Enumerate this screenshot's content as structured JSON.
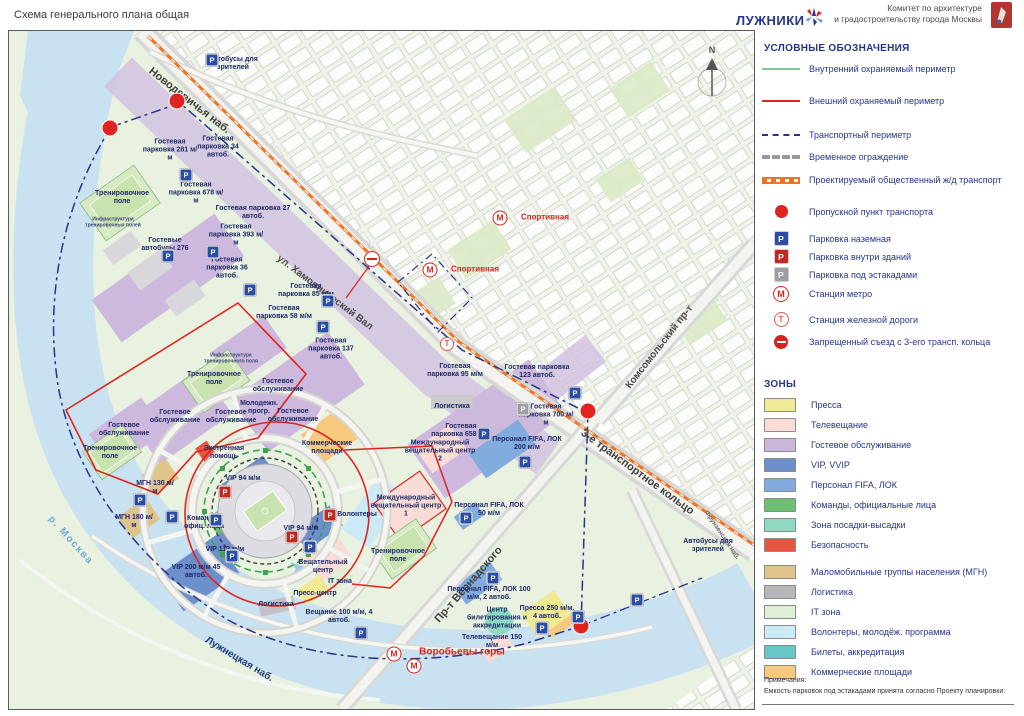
{
  "header": {
    "title": "Схема генерального плана общая",
    "logo_text": "ЛУЖНИКИ",
    "committee_line1": "Комитет по архитектуре",
    "committee_line2": "и градостроительству города Москвы"
  },
  "colors": {
    "perimeter_inner": "#7DC98F",
    "perimeter_outer": "#E0231E",
    "transport_perimeter": "#27348B",
    "temporary_fence": "#9A9A9A",
    "rail_transport": "#EE7425",
    "checkpoint": "#E0231E",
    "metro": "#D7241E",
    "rail_station": "#E2564F",
    "parking_ground": "#2B4EA2",
    "parking_inside": "#C22A21",
    "parking_under": "#9D9DA4"
  },
  "legend": {
    "title": "УСЛОВНЫЕ ОБОЗНАЧЕНИЯ",
    "items": [
      {
        "label": "Внутренний охраняемый периметр"
      },
      {
        "label": "Внешний охраняемый периметр"
      },
      {
        "label": "Транспортный периметр"
      },
      {
        "label": "Временное ограждение"
      },
      {
        "label": "Проектируемый общественный ж/д транспорт"
      },
      {
        "label": "Пропускной пункт транспорта"
      },
      {
        "label": "Парковка наземная"
      },
      {
        "label": "Парковка внутри зданий"
      },
      {
        "label": "Парковка под эстакадами"
      },
      {
        "label": "Станция метро"
      },
      {
        "label": "Станция железной дороги"
      },
      {
        "label": "Запрещенный съезд с 3-его трансп. кольца"
      }
    ],
    "zones_title": "ЗОНЫ",
    "zones": [
      {
        "label": "Пресса",
        "color": "#F0EA96"
      },
      {
        "label": "Телевещание",
        "color": "#F9DCD5"
      },
      {
        "label": "Гостевое обслуживание",
        "color": "#CBB6DC"
      },
      {
        "label": "VIP, VVIP",
        "color": "#6D8FCB"
      },
      {
        "label": "Персонал FIFA, ЛОК",
        "color": "#82ACDE"
      },
      {
        "label": "Команды, официальные лица",
        "color": "#6CBE70"
      },
      {
        "label": "Зона посадки-высадки",
        "color": "#8ED9C2"
      },
      {
        "label": "Безопасность",
        "color": "#E85440"
      },
      {
        "label": "Маломобильные группы населения (МГН)",
        "color": "#DFC489"
      },
      {
        "label": "Логистика",
        "color": "#B5B5BA"
      },
      {
        "label": "IT зона",
        "color": "#DFEFD6"
      },
      {
        "label": "Волонтеры, молодёж. программа",
        "color": "#CCE9F6"
      },
      {
        "label": "Билеты, аккредитация",
        "color": "#66C6C8"
      },
      {
        "label": "Коммерческие площади",
        "color": "#F6CA7E"
      }
    ],
    "notes_title": "Примечания:",
    "notes_text": "Емкость парковок под эстакадами принята согласно Проекту планировки."
  },
  "map": {
    "compass": "N",
    "p_glyph": "P",
    "m_glyph": "М",
    "t_glyph": "Т",
    "streets": [
      {
        "text": "Новодевичья наб.",
        "x": 150,
        "y": 64,
        "rot": 38,
        "cls": "street-lg"
      },
      {
        "text": "ул. Хамовнический Вал",
        "x": 278,
        "y": 252,
        "rot": 37
      },
      {
        "text": "Комсомольский пр-т",
        "x": 628,
        "y": 382,
        "rot": -52
      },
      {
        "text": "3-е транспортное кольцо",
        "x": 582,
        "y": 426,
        "rot": 36,
        "cls": "street-lg"
      },
      {
        "text": "Пр-т Вернадского",
        "x": 437,
        "y": 615,
        "rot": -49,
        "cls": "street-lg"
      },
      {
        "text": "Лужнецкая наб.",
        "x": 206,
        "y": 634,
        "rot": 31,
        "cls": "street-navy"
      },
      {
        "text": "р. Москва",
        "x": 50,
        "y": 512,
        "rot": 48,
        "cls": "street-water"
      },
      {
        "text": "Фрунзенская наб.",
        "x": 706,
        "y": 508,
        "rot": 56,
        "cls": "street-sm"
      }
    ],
    "labels": [
      {
        "text": "Автобусы для зрителей",
        "x": 233,
        "y": 64,
        "w": 64
      },
      {
        "text": "Гостевая парковка 281 м/м",
        "x": 170,
        "y": 150,
        "w": 56
      },
      {
        "text": "Гостевая парковка 34 автоб.",
        "x": 218,
        "y": 147,
        "w": 60
      },
      {
        "text": "Гостевая парковка 678 м/м",
        "x": 196,
        "y": 193,
        "w": 56
      },
      {
        "text": "Гостевая парковка 27 автоб.",
        "x": 253,
        "y": 213,
        "w": 82
      },
      {
        "text": "Гостевая парковка 393 м/м",
        "x": 236,
        "y": 235,
        "w": 56
      },
      {
        "text": "Тренировочное поле",
        "x": 122,
        "y": 198,
        "w": 64
      },
      {
        "text": "Инфраструктура тренировочных полей",
        "x": 113,
        "y": 223,
        "w": 72,
        "cls": "maplabel-tiny"
      },
      {
        "text": "Гостевые автобусы 276",
        "x": 165,
        "y": 245,
        "w": 64
      },
      {
        "text": "Гостевая парковка 36 автоб.",
        "x": 227,
        "y": 268,
        "w": 60
      },
      {
        "text": "Гостевая парковка 85 м/м",
        "x": 306,
        "y": 291,
        "w": 56
      },
      {
        "text": "Гостевая парковка 58 м/м",
        "x": 284,
        "y": 313,
        "w": 56
      },
      {
        "text": "Гостевая парковка 137 автоб.",
        "x": 331,
        "y": 349,
        "w": 60
      },
      {
        "text": "Инфраструктура тренировочного поля",
        "x": 231,
        "y": 359,
        "w": 72,
        "cls": "maplabel-tiny"
      },
      {
        "text": "Тренировочное поле",
        "x": 214,
        "y": 379,
        "w": 64
      },
      {
        "text": "Гостевое обслуживание",
        "x": 278,
        "y": 386,
        "w": 66
      },
      {
        "text": "Молодежн. прогр.",
        "x": 259,
        "y": 408,
        "w": 54
      },
      {
        "text": "Гостевое обслуживание",
        "x": 293,
        "y": 416,
        "w": 60
      },
      {
        "text": "Гостевое обслуживание",
        "x": 231,
        "y": 417,
        "w": 60
      },
      {
        "text": "Гостевое обслуживание",
        "x": 175,
        "y": 417,
        "w": 66
      },
      {
        "text": "Гостевое обслуживание",
        "x": 124,
        "y": 430,
        "w": 66
      },
      {
        "text": "Тренировочное поле",
        "x": 110,
        "y": 453,
        "w": 64
      },
      {
        "text": "Коммерческие площади",
        "x": 327,
        "y": 448,
        "w": 68
      },
      {
        "text": "Экстренная помощь",
        "x": 224,
        "y": 453,
        "w": 58
      },
      {
        "text": "VIP 94 м/м",
        "x": 243,
        "y": 479,
        "w": 44
      },
      {
        "text": "МГН 130 м/м",
        "x": 155,
        "y": 488,
        "w": 40
      },
      {
        "text": "МГН 180 м/м",
        "x": 134,
        "y": 522,
        "w": 40
      },
      {
        "text": "Команды, офиц. лица",
        "x": 204,
        "y": 523,
        "w": 54
      },
      {
        "text": "VIP 112 м/м",
        "x": 225,
        "y": 550,
        "w": 44
      },
      {
        "text": "VIP 200 м/м 45 автоб.",
        "x": 196,
        "y": 572,
        "w": 56
      },
      {
        "text": "VIP 94 м/м",
        "x": 301,
        "y": 529,
        "w": 40
      },
      {
        "text": "Волонтеры",
        "x": 357,
        "y": 515,
        "w": 56
      },
      {
        "text": "Вещательный центр",
        "x": 323,
        "y": 567,
        "w": 62
      },
      {
        "text": "IT зона",
        "x": 340,
        "y": 582,
        "w": 40
      },
      {
        "text": "Пресс-центр",
        "x": 315,
        "y": 594,
        "w": 56
      },
      {
        "text": "Логистика",
        "x": 276,
        "y": 605,
        "w": 50
      },
      {
        "text": "Вещание 100 м/м, 4 автоб.",
        "x": 339,
        "y": 617,
        "w": 74
      },
      {
        "text": "Международный вещательный центр 1",
        "x": 406,
        "y": 506,
        "w": 72
      },
      {
        "text": "Тренировочное поле",
        "x": 398,
        "y": 556,
        "w": 64
      },
      {
        "text": "Международный вещательный центр 2",
        "x": 440,
        "y": 451,
        "w": 72
      },
      {
        "text": "Логистика",
        "x": 452,
        "y": 407,
        "w": 50
      },
      {
        "text": "Гостевая парковка 658 м/м",
        "x": 461,
        "y": 431,
        "w": 60
      },
      {
        "text": "Гостевая парковка 700 м/м",
        "x": 546,
        "y": 415,
        "w": 56
      },
      {
        "text": "Персонал FIFA, ЛОК 200 м/м",
        "x": 527,
        "y": 444,
        "w": 70
      },
      {
        "text": "Персонал FIFA, ЛОК 50 м/м",
        "x": 489,
        "y": 510,
        "w": 74
      },
      {
        "text": "Гостевая парковка 95 м/м",
        "x": 455,
        "y": 371,
        "w": 56
      },
      {
        "text": "Гостевая парковка 123 автоб.",
        "x": 537,
        "y": 372,
        "w": 66
      },
      {
        "text": "Персонал FIFA, ЛОК 100 м/м, 2 автоб.",
        "x": 489,
        "y": 594,
        "w": 86
      },
      {
        "text": "Центр билетирования и аккредитации",
        "x": 497,
        "y": 618,
        "w": 66
      },
      {
        "text": "Пресса 250 м/м, 4 автоб.",
        "x": 547,
        "y": 613,
        "w": 58
      },
      {
        "text": "Телевещание 150 м/м",
        "x": 492,
        "y": 642,
        "w": 62
      },
      {
        "text": "Автобусы для зрителей",
        "x": 708,
        "y": 546,
        "w": 62
      }
    ],
    "red_labels": [
      {
        "text": "Спортивная",
        "x": 545,
        "y": 218
      },
      {
        "text": "Спортивная",
        "x": 475,
        "y": 270
      },
      {
        "text": "Воробьевы горы",
        "x": 462,
        "y": 652,
        "cls": "maplabel-big"
      }
    ],
    "checkpoints": [
      {
        "x": 110,
        "y": 128
      },
      {
        "x": 177,
        "y": 101
      },
      {
        "x": 588,
        "y": 411
      },
      {
        "x": 581,
        "y": 626
      }
    ],
    "metro": [
      {
        "x": 500,
        "y": 218
      },
      {
        "x": 430,
        "y": 270
      },
      {
        "x": 394,
        "y": 654
      },
      {
        "x": 414,
        "y": 666
      }
    ],
    "rail_stations": [
      {
        "x": 447,
        "y": 344
      }
    ],
    "noentry": [
      {
        "x": 372,
        "y": 259
      }
    ],
    "parkings": [
      {
        "x": 212,
        "y": 60,
        "cls": "p-blue"
      },
      {
        "x": 186,
        "y": 175,
        "cls": "p-blue"
      },
      {
        "x": 168,
        "y": 256,
        "cls": "p-blue"
      },
      {
        "x": 213,
        "y": 252,
        "cls": "p-blue"
      },
      {
        "x": 250,
        "y": 290,
        "cls": "p-blue"
      },
      {
        "x": 328,
        "y": 301,
        "cls": "p-blue"
      },
      {
        "x": 323,
        "y": 327,
        "cls": "p-blue"
      },
      {
        "x": 575,
        "y": 393,
        "cls": "p-blue"
      },
      {
        "x": 484,
        "y": 434,
        "cls": "p-blue"
      },
      {
        "x": 525,
        "y": 462,
        "cls": "p-blue"
      },
      {
        "x": 466,
        "y": 518,
        "cls": "p-blue"
      },
      {
        "x": 140,
        "y": 500,
        "cls": "p-blue"
      },
      {
        "x": 172,
        "y": 517,
        "cls": "p-blue"
      },
      {
        "x": 216,
        "y": 520,
        "cls": "p-blue"
      },
      {
        "x": 232,
        "y": 556,
        "cls": "p-blue"
      },
      {
        "x": 310,
        "y": 547,
        "cls": "p-blue"
      },
      {
        "x": 361,
        "y": 633,
        "cls": "p-blue"
      },
      {
        "x": 493,
        "y": 578,
        "cls": "p-blue"
      },
      {
        "x": 542,
        "y": 628,
        "cls": "p-blue"
      },
      {
        "x": 637,
        "y": 600,
        "cls": "p-blue"
      },
      {
        "x": 578,
        "y": 617,
        "cls": "p-blue"
      },
      {
        "x": 225,
        "y": 492,
        "cls": "p-red"
      },
      {
        "x": 292,
        "y": 537,
        "cls": "p-red"
      },
      {
        "x": 330,
        "y": 515,
        "cls": "p-red"
      },
      {
        "x": 523,
        "y": 409,
        "cls": "p-gray"
      }
    ]
  }
}
